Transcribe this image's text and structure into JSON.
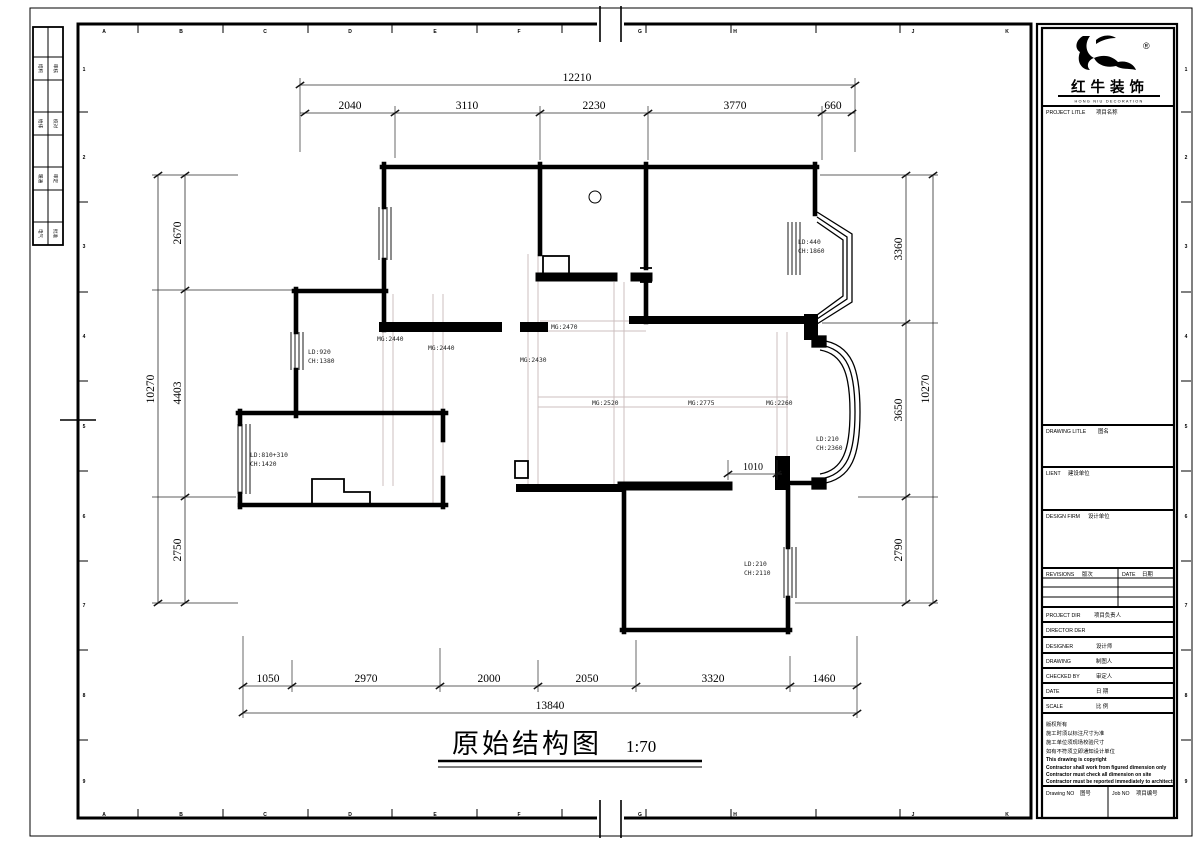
{
  "sheet": {
    "footer_title": "原始结构图",
    "footer_scale": "1:70"
  },
  "brand": {
    "logo_text": "红牛装饰",
    "logo_sub": "HONG NIU DECORATION",
    "registered": "®"
  },
  "titleblock": {
    "project_title_en": "PROJECT LITLE",
    "project_title_cn": "项目名称",
    "drawing_title_en": "DRAWING LITLE",
    "drawing_title_cn": "图名",
    "client_en": "LIENT",
    "client_cn": "建设单位",
    "design_firm_en": "DESIGN FIRM",
    "design_firm_cn": "设计单位",
    "revisions_en": "REVISIONS",
    "revisions_cn": "版次",
    "date_col_en": "DATE",
    "date_col_cn": "日期",
    "project_dir_en": "PROJECT DIR",
    "project_dir_cn": "项目负责人",
    "director_en": "DIRECTOR DER",
    "director_cn": "",
    "designer_en": "DESIGNER",
    "designer_cn": "设计师",
    "drawing_by_en": "DRAWING",
    "drawing_by_cn": "制图人",
    "checked_by_en": "CHECKED BY",
    "checked_by_cn": "审定人",
    "date_en": "DATE",
    "date_cn": "日 期",
    "scale_en": "SCALE",
    "scale_cn": "比 例",
    "drawing_no_en": "Drawing NO",
    "drawing_no_cn": "图号",
    "job_no_en": "Job NO",
    "job_no_cn": "项目编号",
    "notes": [
      "版权所有",
      "施工时须以标注尺寸为准",
      "施工单位须现场校验尺寸",
      "如有不符须立即通知设计单位",
      "This drawing is copyright",
      "Contractor shall work from figured dimension only",
      "Contractor must check all dimension on site",
      "Contractor must be reported immediately to architects"
    ]
  },
  "grid": {
    "cols": [
      "A",
      "B",
      "C",
      "D",
      "E",
      "F",
      "G",
      "H",
      "J",
      "K"
    ],
    "rows": [
      "1",
      "2",
      "3",
      "4",
      "5",
      "6",
      "7",
      "8",
      "9"
    ]
  },
  "stamps": [
    {
      "a": "结构",
      "b": "审核"
    },
    {
      "a": "给排",
      "b": "校对"
    },
    {
      "a": "暖通",
      "b": "审定"
    },
    {
      "a": "电气",
      "b": "批准"
    }
  ],
  "dims": {
    "top": {
      "overall": "12210",
      "segments": [
        "2040",
        "3110",
        "2230",
        "3770",
        "660"
      ]
    },
    "bottom": {
      "overall": "13840",
      "segments": [
        "1050",
        "2970",
        "2000",
        "2050",
        "3320",
        "1460"
      ]
    },
    "left": {
      "overall": "10270",
      "segments": [
        "2670",
        "4403",
        "2750"
      ]
    },
    "right": {
      "overall": "10270",
      "segments": [
        "3360",
        "3650",
        "2790"
      ]
    },
    "opening": "1010"
  },
  "openings": [
    {
      "ld": "LD:920",
      "ch": "CH:1380"
    },
    {
      "ld": "LD:440",
      "ch": "CH:1860"
    },
    {
      "ld": "LD:810+310",
      "ch": "CH:1420"
    },
    {
      "ld": "LD:210",
      "ch": "CH:2360"
    },
    {
      "ld": "LD:210",
      "ch": "CH:2110"
    }
  ],
  "beams": [
    "MG:2440",
    "MG:2440",
    "MG:2470",
    "MG:2430",
    "MG:2520",
    "MG:2775",
    "MG:2260"
  ]
}
